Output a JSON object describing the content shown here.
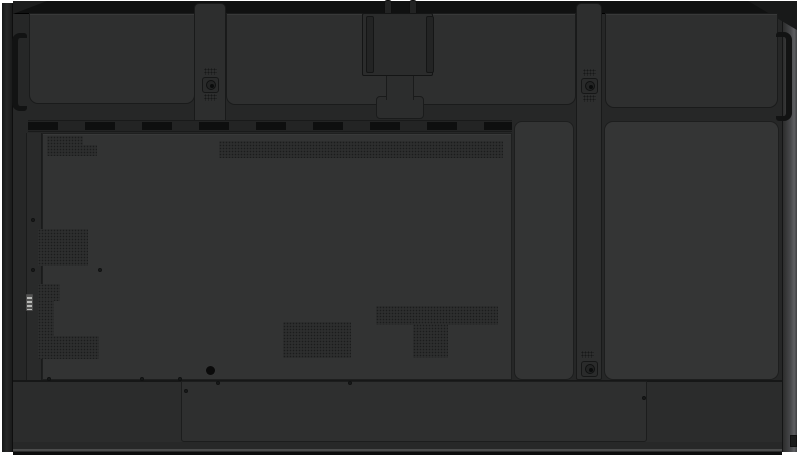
{
  "scene": {
    "description": "Rear view product photograph of a large wall-mountable flat-panel display (no visible text)",
    "background": "#ffffff"
  },
  "palette": {
    "chassis": "#262727",
    "edge": "#101111",
    "topPanel": "#2e2f2f",
    "mainPanel": "#323333",
    "door": "#343535",
    "strap": "#2d2e2e",
    "bottom": "#2b2c2c",
    "box": "#2e2f2f",
    "sideRightA": "#2c2d2d",
    "sideRightB": "#5e5f62",
    "handle": "#121313",
    "dash": "#0e0f0f",
    "dot": "#1b1c1c",
    "connector": "#b9bab8"
  },
  "features": {
    "vents": [
      {
        "name": "vent-grid-top-left-upper",
        "x": 47,
        "y": 136,
        "w": 36,
        "h": 10
      },
      {
        "name": "vent-grid-top-left-lower",
        "x": 47,
        "y": 145,
        "w": 50,
        "h": 11
      },
      {
        "name": "vent-strip-top-center",
        "x": 219,
        "y": 141,
        "w": 284,
        "h": 17
      },
      {
        "name": "vent-grid-left-rect",
        "x": 38,
        "y": 229,
        "w": 50,
        "h": 37
      },
      {
        "name": "vent-l-shape-top",
        "x": 38,
        "y": 284,
        "w": 22,
        "h": 17
      },
      {
        "name": "vent-l-shape-stem",
        "x": 38,
        "y": 300,
        "w": 16,
        "h": 37
      },
      {
        "name": "vent-l-shape-base",
        "x": 38,
        "y": 336,
        "w": 61,
        "h": 23
      },
      {
        "name": "vent-grid-center-rect",
        "x": 283,
        "y": 322,
        "w": 68,
        "h": 36
      },
      {
        "name": "vent-t-shape-bar",
        "x": 376,
        "y": 306,
        "w": 122,
        "h": 19
      },
      {
        "name": "vent-t-shape-stem",
        "x": 413,
        "y": 324,
        "w": 35,
        "h": 34
      }
    ],
    "mount_screws": [
      {
        "name": "mount-screw-top-left",
        "cx": 210,
        "cy": 85
      },
      {
        "name": "mount-screw-top-right",
        "cx": 589,
        "cy": 86
      },
      {
        "name": "mount-screw-bottom-right",
        "cx": 589,
        "cy": 369
      }
    ],
    "perf_patches": [
      {
        "x": 204,
        "y": 68
      },
      {
        "x": 204,
        "y": 94
      },
      {
        "x": 583,
        "y": 69
      },
      {
        "x": 583,
        "y": 95
      },
      {
        "x": 581,
        "y": 351
      }
    ],
    "small_screws": [
      {
        "x": 47,
        "y": 377
      },
      {
        "x": 140,
        "y": 377
      },
      {
        "x": 178,
        "y": 377
      },
      {
        "x": 216,
        "y": 381
      },
      {
        "x": 348,
        "y": 381
      },
      {
        "x": 184,
        "y": 389
      },
      {
        "x": 642,
        "y": 396
      },
      {
        "x": 98,
        "y": 268
      },
      {
        "x": 31,
        "y": 218
      },
      {
        "x": 31,
        "y": 268
      }
    ],
    "holes": [
      {
        "name": "cable-hole-bottom-left",
        "x": 206,
        "y": 366,
        "d": 9
      }
    ]
  }
}
